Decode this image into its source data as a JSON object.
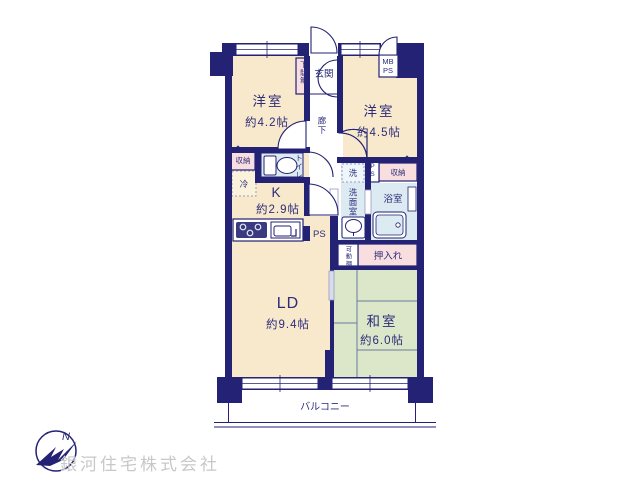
{
  "colors": {
    "wall": "#232274",
    "room_cream": "#f8e9cc",
    "tatami_green": "#dbe7c8",
    "wet_blue": "#dceaf2",
    "closet_pink": "#f8dede",
    "text_navy": "#2c2c7a",
    "watermark_gray": "#c8c8c8"
  },
  "rooms": {
    "western1": {
      "label": "洋室",
      "size": "約4.2帖"
    },
    "western2": {
      "label": "洋室",
      "size": "約4.5帖"
    },
    "kitchen": {
      "label": "K",
      "size": "約2.9帖"
    },
    "living": {
      "label": "LD",
      "size": "約9.4帖"
    },
    "japanese": {
      "label": "和室",
      "size": "約6.0帖"
    },
    "entrance": {
      "label": "玄関"
    },
    "hallway": {
      "label": "廊下"
    },
    "toilet": {
      "label": "トイレ"
    },
    "washroom": {
      "label": "洗面室"
    },
    "bath": {
      "label": "浴室"
    },
    "balcony": {
      "label": "バルコニー"
    }
  },
  "fixtures": {
    "shoe_cabinet": "下駄箱",
    "storage_left": "収納",
    "storage_right": "収納",
    "fridge": "冷",
    "washer": "洗",
    "mb_line1": "MB",
    "mb_line2": "PS",
    "ps_kitchen": "PS",
    "ps_washroom": "PS",
    "movable_shelf": "可動棚",
    "closet": "押入れ"
  },
  "compass": {
    "north": "N"
  },
  "watermark": {
    "text": "銀河住宅株式会社"
  }
}
